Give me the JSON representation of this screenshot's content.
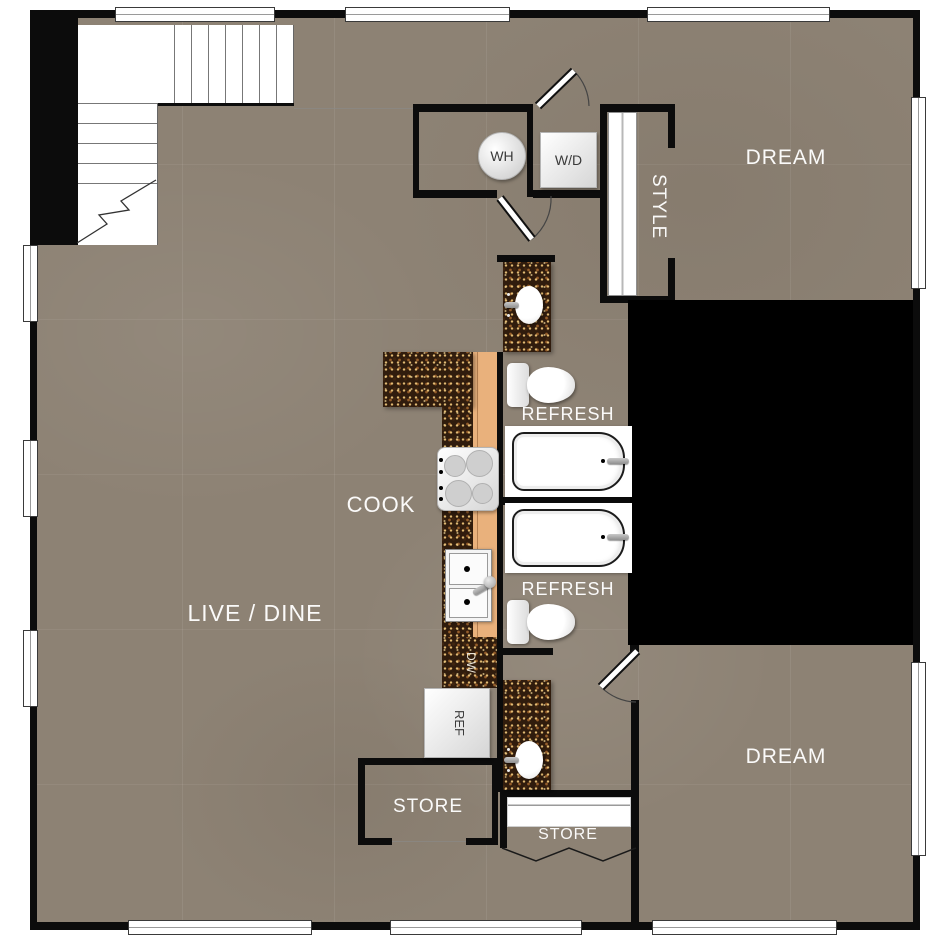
{
  "plan_title": "apartment-floor-plan",
  "rooms": {
    "live_dine": "LIVE / DINE",
    "cook": "COOK",
    "dream_top": "DREAM",
    "dream_bottom": "DREAM",
    "refresh_top": "REFRESH",
    "refresh_bottom": "REFRESH",
    "style": "STYLE",
    "store_room": "STORE",
    "store_closet": "STORE"
  },
  "fixtures": {
    "water_heater": "WH",
    "washer_dryer": "W/D",
    "dishwasher": "DW",
    "refrigerator": "REF"
  },
  "colors": {
    "floor": "#8d8274",
    "wall": "#0c0c0c",
    "void": "#000000",
    "counter_granite": "#301c0d",
    "cabinet": "#e9b17c",
    "fixture": "#ffffff",
    "room_label": "#ffffff",
    "appliance_label": "#3a3a3a"
  }
}
